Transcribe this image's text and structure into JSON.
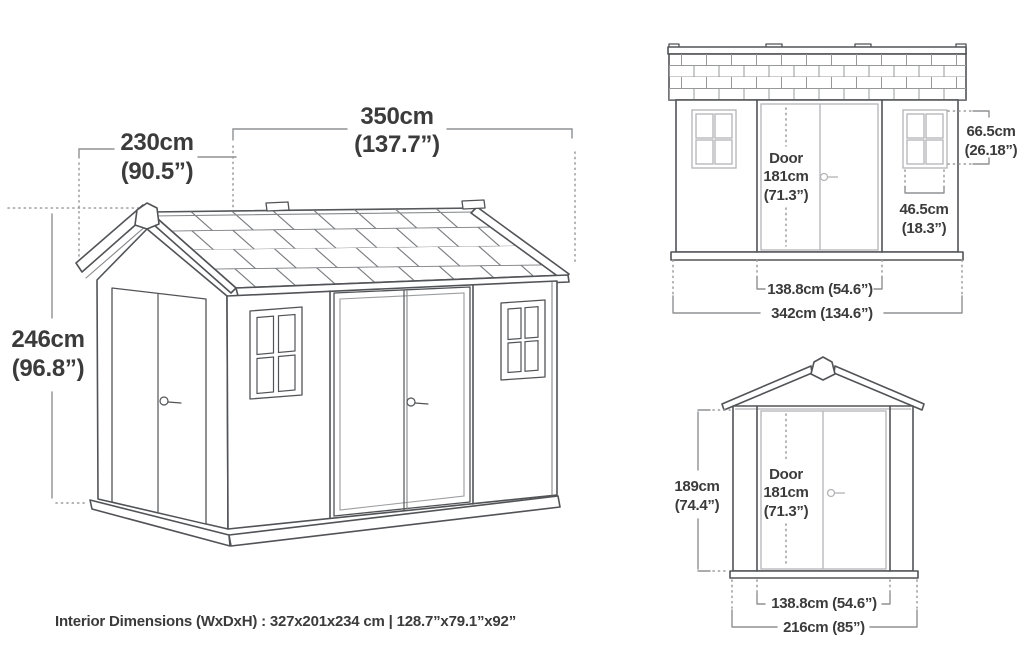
{
  "colors": {
    "background": "#ffffff",
    "line_dark": "#515356",
    "line_light": "#b3b4b6",
    "dimension_line": "#8f9092",
    "text": "#3b3b3b"
  },
  "perspective_view": {
    "dims": {
      "depth": {
        "cm": "230cm",
        "in": "(90.5”)"
      },
      "width": {
        "cm": "350cm",
        "in": "(137.7”)"
      },
      "height": {
        "cm": "246cm",
        "in": "(96.8”)"
      }
    }
  },
  "side_elevation": {
    "door": {
      "label": "Door",
      "height_cm": "181cm",
      "height_in": "(71.3”)"
    },
    "dims": {
      "window_height": {
        "cm": "66.5cm",
        "in": "(26.18”)"
      },
      "window_width": {
        "cm": "46.5cm",
        "in": "(18.3”)"
      },
      "door_width": "138.8cm (54.6”)",
      "total_width": "342cm (134.6”)"
    }
  },
  "front_elevation": {
    "door": {
      "label": "Door",
      "height_cm": "181cm",
      "height_in": "(71.3”)"
    },
    "dims": {
      "height": {
        "cm": "189cm",
        "in": "(74.4”)"
      },
      "door_width": "138.8cm (54.6”)",
      "total_width": "216cm (85”)"
    }
  },
  "footer": {
    "interior_dimensions": "Interior Dimensions (WxDxH) : 327x201x234 cm | 128.7”x79.1”x92”"
  }
}
